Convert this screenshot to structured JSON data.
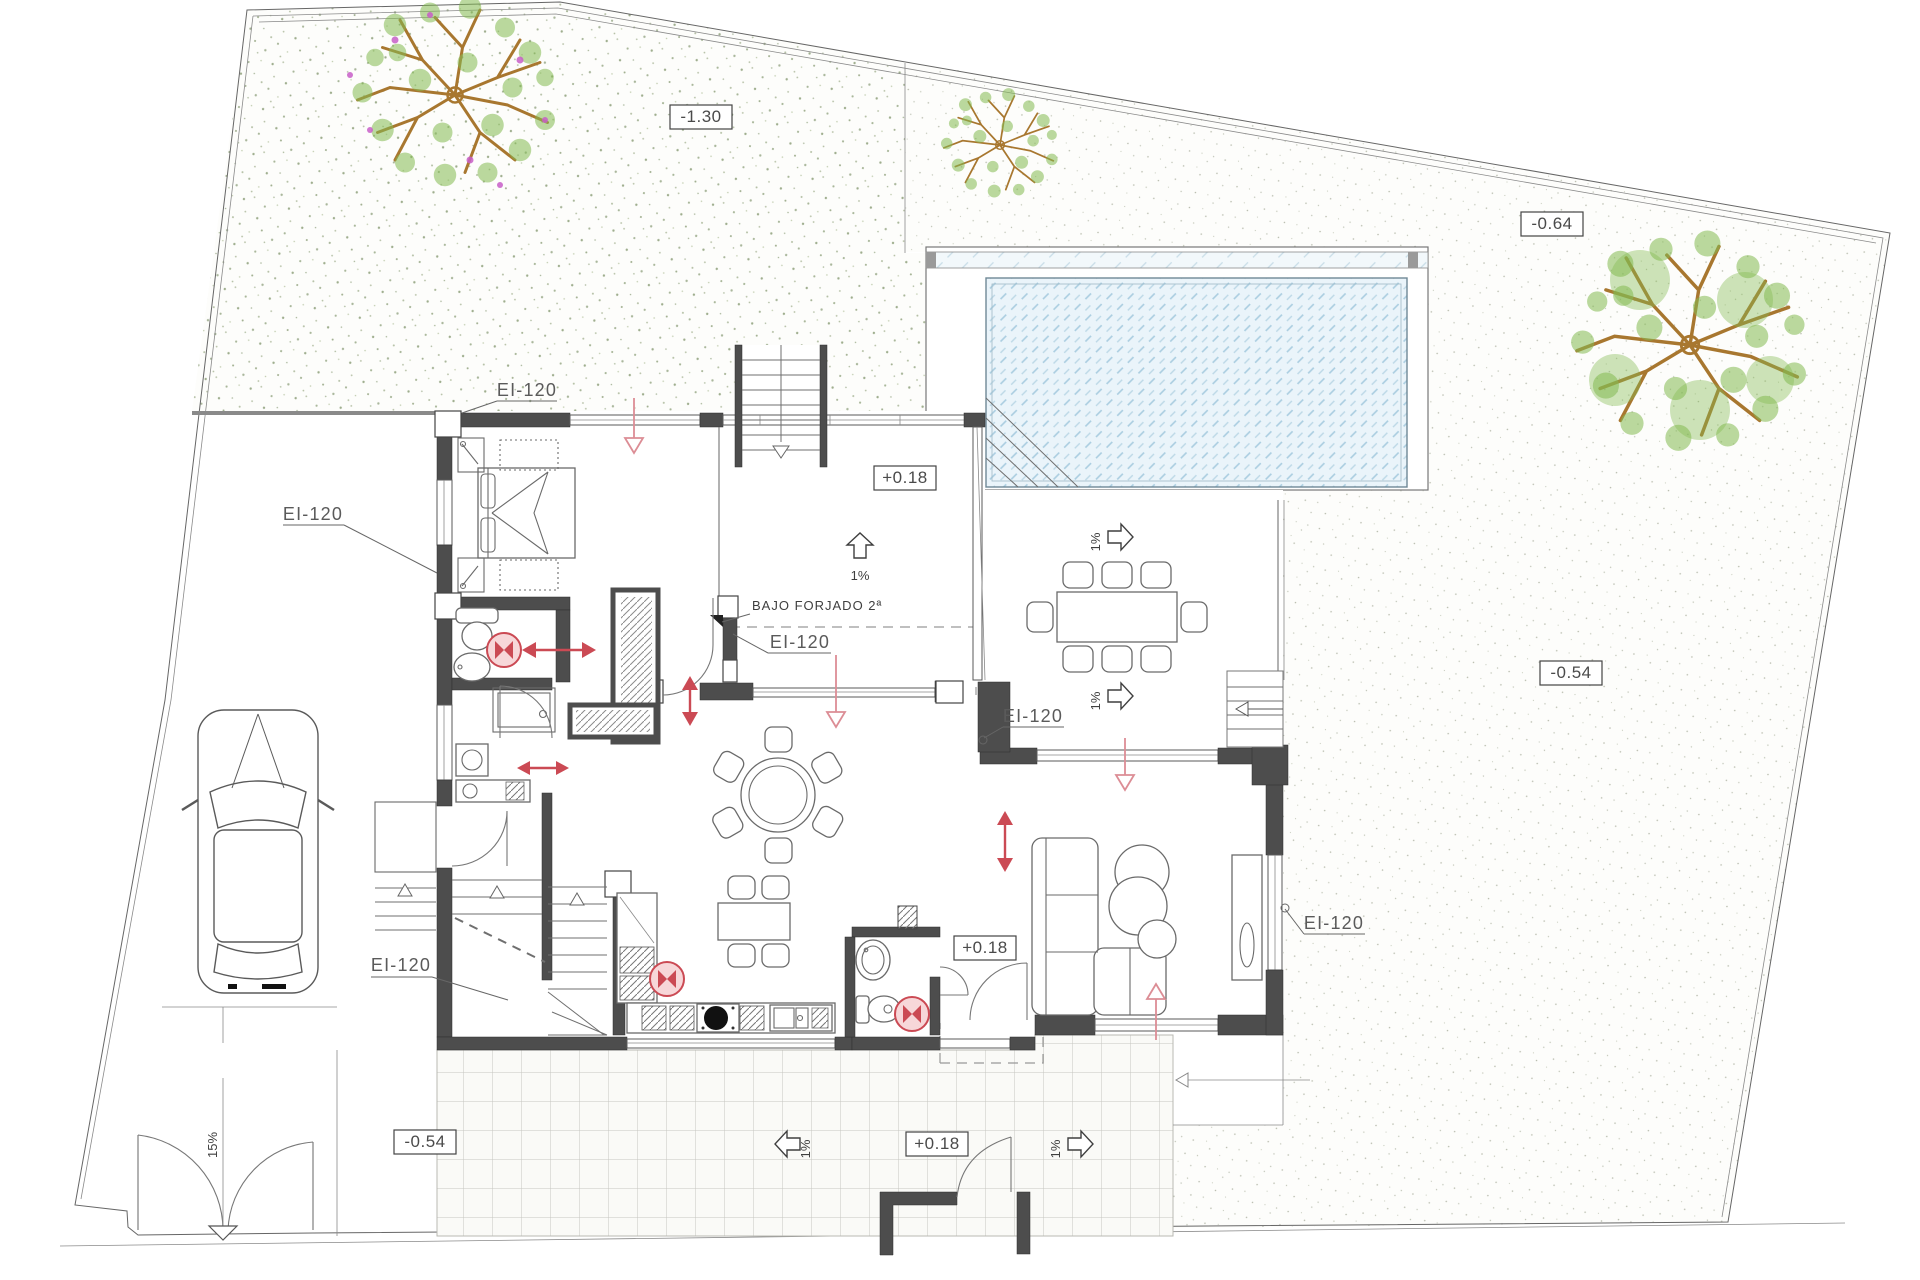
{
  "drawing": {
    "type": "architectural-site-floor-plan",
    "labels": {
      "ei120": "EI-120",
      "bajo_forjado": "BAJO FORJADO 2ª",
      "lv_garden_nw": "-1.30",
      "lv_garden_ne": "-0.64",
      "lv_garden_e": "-0.54",
      "lv_driveway": "-0.54",
      "lv_main_floor": "+0.18",
      "lv_hall": "+0.18",
      "lv_terrace": "+0.18",
      "slope_pct": "1%",
      "slope_ramp": "15%"
    },
    "colors": {
      "wall": "#4d4d4d",
      "red_symbol": "#cb4a54",
      "pool_fill": "#eaf4fa",
      "pool_hatch": "#a9cde0",
      "leaf_green": "#84bb52",
      "branch_brown": "#a8772f",
      "flower_magenta": "#c85fc8",
      "stipple": "#aab79a",
      "tile_line": "#c6c6c0"
    }
  }
}
